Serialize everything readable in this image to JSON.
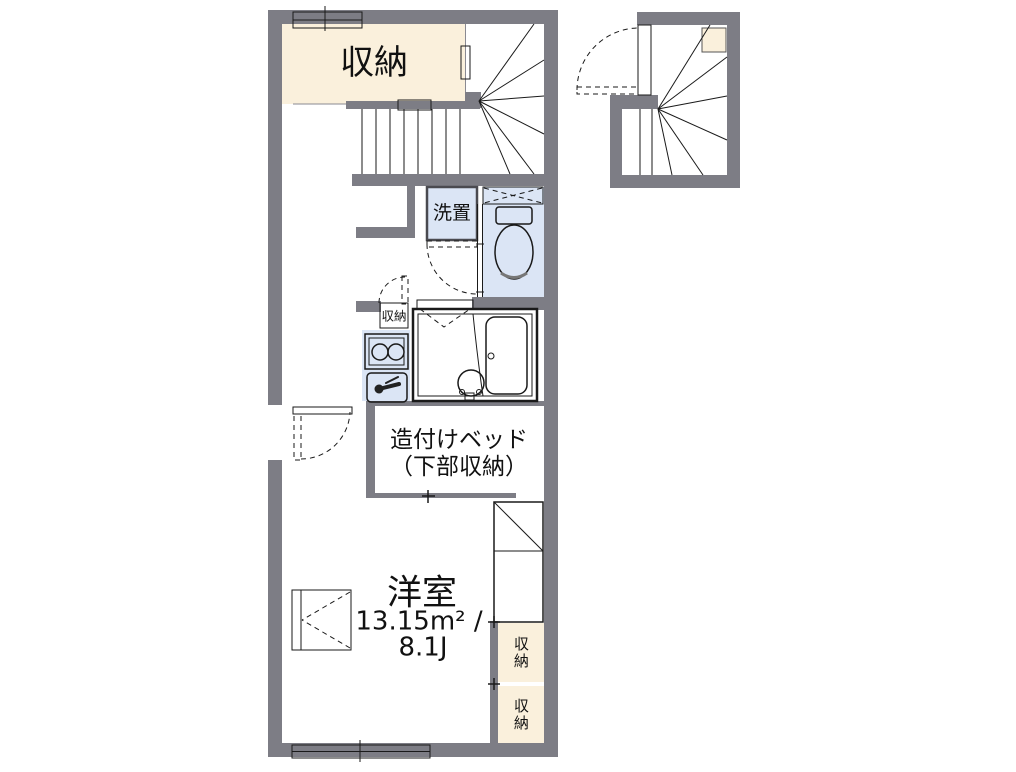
{
  "floor_plan": {
    "unit": {
      "closet_top_label": "収納",
      "washer_label": "洗置",
      "kitchen_storage_label": "収納",
      "bed_label_line1": "造付けベッド",
      "bed_label_line2": "（下部収納）",
      "room_name": "洋室",
      "room_area_sqm": "13.15m² /",
      "room_area_tatami": "8.1J",
      "closet_right_upper_label": "収納",
      "closet_right_lower_label": "収納"
    },
    "colors": {
      "wall": "#7d7d85",
      "closet_fill": "#faf0dc",
      "wet_area_fill": "#dbe5f5",
      "fixture_fill": "#eef4fc",
      "line": "#1a1a1a"
    }
  }
}
